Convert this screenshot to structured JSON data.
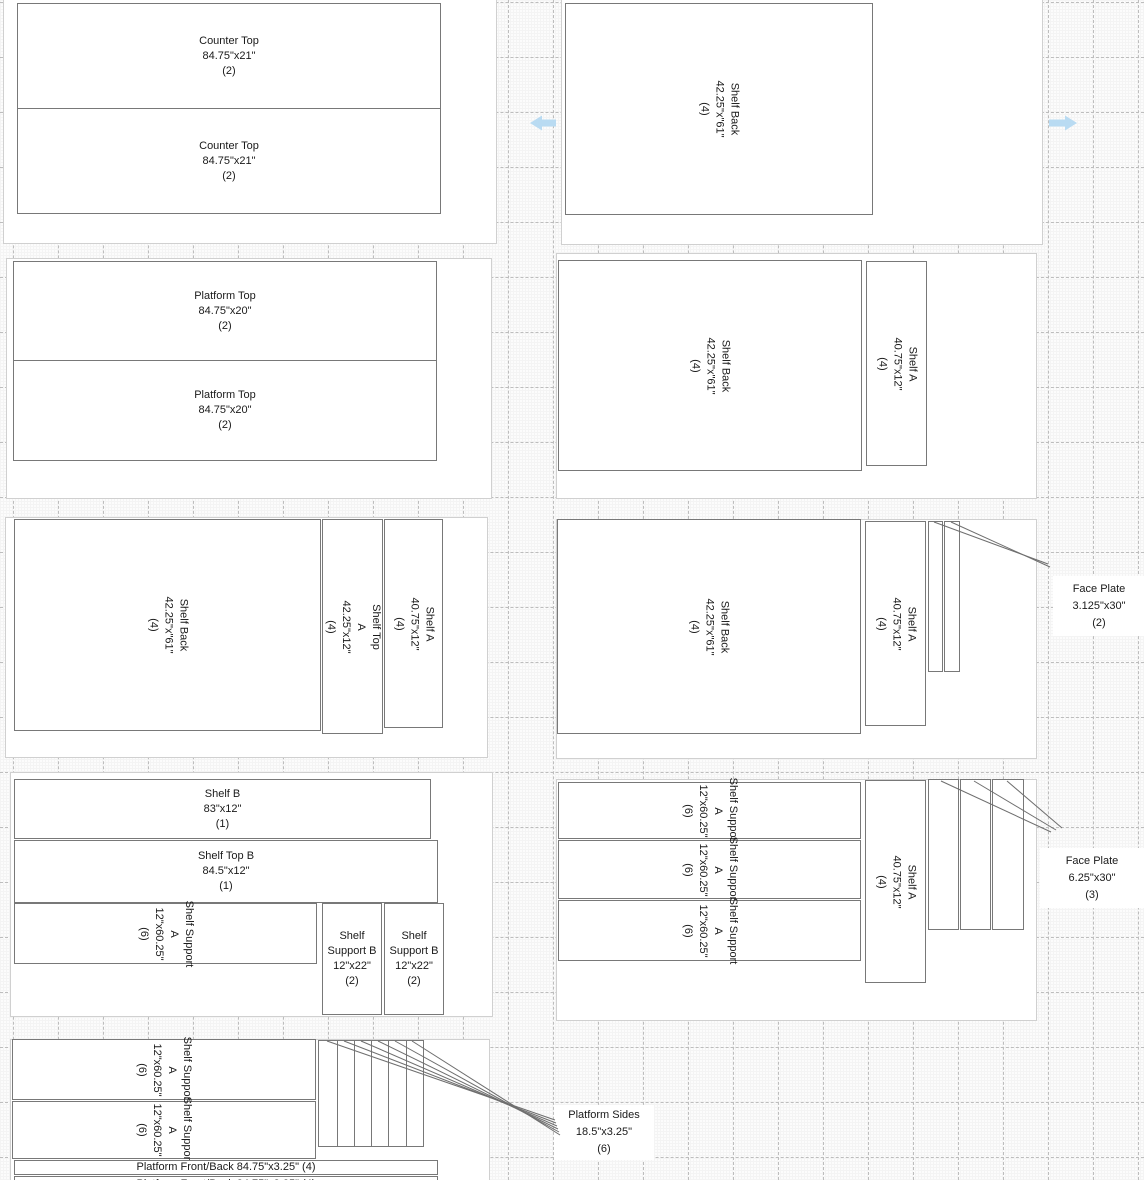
{
  "parts": {
    "counter_top": {
      "name": "Counter Top",
      "dim": "84.75\"x21\"",
      "qty": "(2)"
    },
    "platform_top": {
      "name": "Platform Top",
      "dim": "84.75\"x20\"",
      "qty": "(2)"
    },
    "shelf_back": {
      "name": "Shelf Back",
      "dim": "42.25\"x\"61\"",
      "qty": "(4)"
    },
    "shelf_a": {
      "name": "Shelf A",
      "dim": "40.75\"x12\"",
      "qty": "(4)"
    },
    "shelf_top_a": {
      "name": "Shelf Top A",
      "dim": "42.25\"x12\"",
      "qty": "(4)"
    },
    "shelf_b": {
      "name": "Shelf B",
      "dim": "83\"x12\"",
      "qty": "(1)"
    },
    "shelf_top_b": {
      "name": "Shelf Top B",
      "dim": "84.5\"x12\"",
      "qty": "(1)"
    },
    "shelf_support_a": {
      "name": "Shelf Support A",
      "dim": "12\"x60.25\"",
      "qty": "(6)"
    },
    "shelf_support_b": {
      "name": "Shelf Support B",
      "dim": "12\"x22\"",
      "qty": "(2)"
    },
    "platform_front_back": {
      "label": "Platform Front/Back 84.75\"x3.25\" (4)"
    }
  },
  "annotations": {
    "face_plate_small": {
      "name": "Face Plate",
      "dim": "3.125\"x30\"",
      "qty": "(2)"
    },
    "face_plate_large": {
      "name": "Face Plate",
      "dim": "6.25\"x30\"",
      "qty": "(3)"
    },
    "platform_sides": {
      "name": "Platform Sides",
      "dim": "18.5\"x3.25\"",
      "qty": "(6)"
    }
  },
  "icons": {
    "pan_left": "left-arrow",
    "pan_right": "right-arrow"
  },
  "colors": {
    "part_border": "#787878",
    "sheet_border": "#d0d0d0",
    "leader_line": "#6e6e6e",
    "pan_arrow": "#b9dbf2",
    "grid_major": "#dcdcdc",
    "grid_dashed": "#bdbdbd"
  }
}
